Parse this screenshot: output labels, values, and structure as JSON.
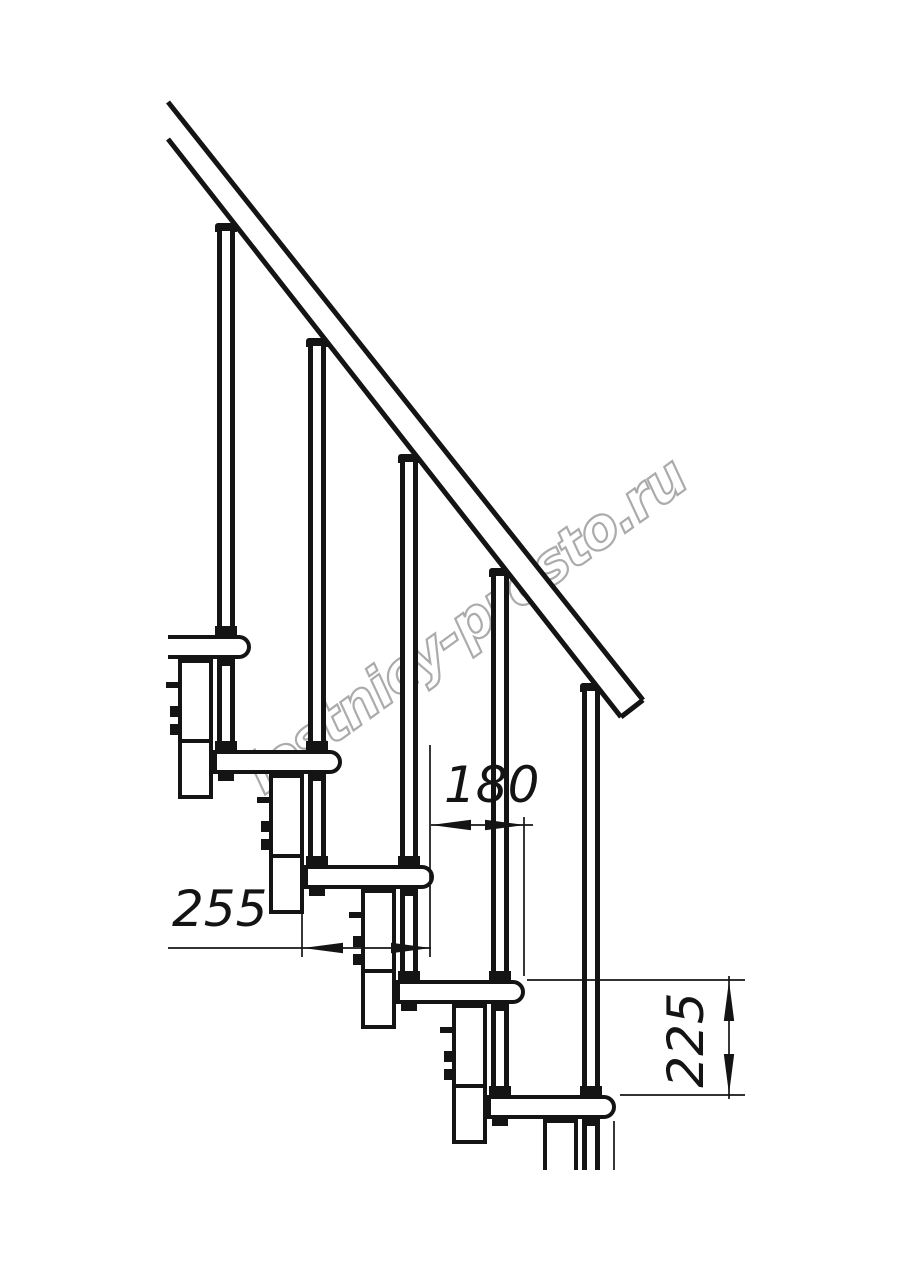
{
  "watermark": {
    "text": "lestnicy-prosto.ru",
    "color": "#ababab",
    "x": 272,
    "y": 742,
    "angle": -36,
    "font_size": 56
  },
  "dimensions": {
    "tread_depth": {
      "label": "255"
    },
    "step_run": {
      "label": "180"
    },
    "step_rise": {
      "label": "225"
    }
  },
  "drawing": {
    "canvas": {
      "w": 914,
      "h": 1280,
      "bg": "#ffffff",
      "line_color": "#141414"
    },
    "handrail": {
      "band": [
        [
          168,
          102
        ],
        [
          643,
          700
        ],
        [
          621,
          717
        ],
        [
          168,
          139
        ]
      ],
      "stroke_width": 5
    },
    "tread_height": 24,
    "tread_nose_radius": 12,
    "outline_stroke": 4,
    "treads": [
      {
        "left": 168,
        "top": 635,
        "nose": 251,
        "open_left": true
      },
      {
        "left": 213,
        "top": 750,
        "nose": 342
      },
      {
        "left": 304,
        "top": 865,
        "nose": 434
      },
      {
        "left": 396,
        "top": 980,
        "nose": 525
      },
      {
        "left": 487,
        "top": 1095,
        "nose": 616
      }
    ],
    "columns": [
      {
        "x": 178,
        "w": 35,
        "top": 659,
        "h": 140,
        "joint": 739,
        "bolts": [
          706,
          724
        ],
        "stub": 682
      },
      {
        "x": 269,
        "w": 35,
        "top": 774,
        "h": 140,
        "joint": 854,
        "bolts": [
          821,
          839
        ],
        "stub": 797
      },
      {
        "x": 361,
        "w": 35,
        "top": 889,
        "h": 140,
        "joint": 969,
        "bolts": [
          936,
          954
        ],
        "stub": 912
      },
      {
        "x": 452,
        "w": 35,
        "top": 1004,
        "h": 140,
        "joint": 1084,
        "bolts": [
          1051,
          1069
        ],
        "stub": 1027
      },
      {
        "x": 543,
        "w": 35,
        "top": 1119,
        "h": 51,
        "joint": null,
        "bolts": [],
        "stub": null,
        "open_bottom": true
      }
    ],
    "balusters": [
      {
        "cx": 226,
        "cap_y": 223
      },
      {
        "cx": 317,
        "cap_y": 338
      },
      {
        "cx": 409,
        "cap_y": 454
      },
      {
        "cx": 500,
        "cap_y": 568
      },
      {
        "cx": 591,
        "cap_y": 683,
        "cut_end": 1170
      }
    ],
    "baluster_outer_w": 18,
    "baluster_line_w": 5,
    "dim_stroke": 1.7,
    "arrow": {
      "len": 40,
      "half": 5.2
    },
    "dims": {
      "d255": {
        "line": {
          "y": 948,
          "x1": 168,
          "x2": 431
        },
        "arrows": [
          {
            "x": 303,
            "y": 948,
            "dir": "left"
          },
          {
            "x": 431,
            "y": 948,
            "dir": "right"
          }
        ],
        "text_pos": {
          "x": 172,
          "y": 884
        }
      },
      "d180": {
        "line": {
          "y": 825,
          "x1": 431,
          "x2": 533
        },
        "arrows": [
          {
            "x": 431,
            "y": 825,
            "dir": "left"
          },
          {
            "x": 525,
            "y": 825,
            "dir": "right"
          }
        ],
        "text_pos": {
          "x": 444,
          "y": 760
        }
      },
      "d225": {
        "line": {
          "x": 729,
          "y1": 976,
          "y2": 1099
        },
        "arrows": [
          {
            "x": 729,
            "y": 981,
            "dir": "up"
          },
          {
            "x": 729,
            "y": 1094,
            "dir": "down"
          }
        ],
        "text_pos": {
          "cx": 686,
          "cy": 1040
        }
      }
    },
    "ext_lines": {
      "vertical": [
        [
          302,
          910,
          957
        ],
        [
          430,
          745,
          957
        ],
        [
          524,
          817,
          976
        ],
        [
          614,
          1121,
          1170
        ]
      ],
      "horizontal": [
        [
          980,
          527,
          745
        ],
        [
          1095,
          620,
          745
        ]
      ]
    }
  }
}
